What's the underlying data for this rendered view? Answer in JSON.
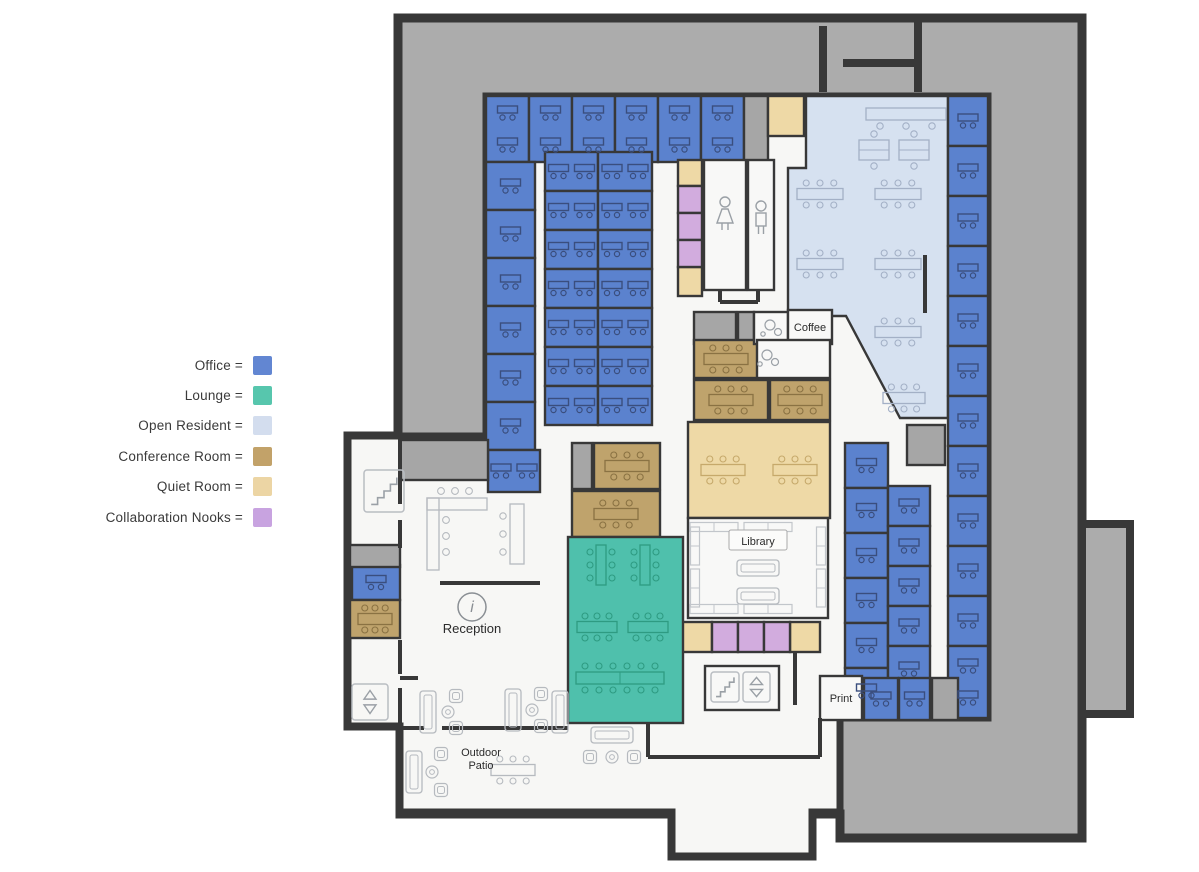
{
  "legend": {
    "items": [
      {
        "name": "office",
        "label": "Office =",
        "color": "#6286D2"
      },
      {
        "name": "lounge",
        "label": "Lounge =",
        "color": "#57C6AD"
      },
      {
        "name": "open-resident",
        "label": "Open Resident =",
        "color": "#D3DDEE"
      },
      {
        "name": "conference-room",
        "label": "Conference Room =",
        "color": "#C2A269"
      },
      {
        "name": "quiet-room",
        "label": "Quiet Room =",
        "color": "#ECD5A4"
      },
      {
        "name": "collaboration-nooks",
        "label": "Collaboration Nooks =",
        "color": "#C8A3E0"
      }
    ]
  },
  "plan": {
    "colors": {
      "wall": "#383838",
      "exterior": "#ACACAC",
      "floor": "#F7F7F5",
      "white": "#F8F8F7",
      "office": "#5B82CE",
      "lounge": "#4FC0AC",
      "open": "#D6E1F0",
      "conference": "#BFA36C",
      "quiet": "#EED9A6",
      "collab": "#D2ACDE",
      "grayroom": "#A6A6A6",
      "furn_office": "#3A4E7E",
      "furn_open": "#A3B0C6",
      "furn_conf": "#8A7243",
      "furn_quiet": "#C6A96B",
      "furn_lounge": "#2E9B82",
      "furn_neutral": "#B6BABF",
      "shelf": "#C2C6CB",
      "icon": "#9AA0A6",
      "iconbox": "#B9BDC2",
      "text": "#2B2B2B",
      "chip_border": "#AAAAAA"
    },
    "silhouette": "398,18 1082,18 1082,838 840,838 840,814 812,814 812,856 672,856 672,814 400,814 400,726 348,726 348,436 398,436",
    "bump": [
      1082,
      524,
      48,
      190
    ],
    "notch_walls": [
      [
        823,
        26,
        823,
        92
      ],
      [
        843,
        63,
        918,
        63
      ],
      [
        918,
        18,
        918,
        92
      ]
    ],
    "floor": "486,96 988,96 988,718 840,718 840,812 812,812 812,856 672,856 672,812 400,812 400,726 348,726 348,436 486,436",
    "open_area": {
      "points": "806,96 948,96 948,418 900,418 846,316 788,316 788,168 806,168"
    },
    "rooms": [
      {
        "t": "office",
        "x": 486,
        "y": 96,
        "w": 43,
        "h": 66
      },
      {
        "t": "office",
        "x": 529,
        "y": 96,
        "w": 43,
        "h": 66
      },
      {
        "t": "office",
        "x": 572,
        "y": 96,
        "w": 43,
        "h": 66
      },
      {
        "t": "office",
        "x": 615,
        "y": 96,
        "w": 43,
        "h": 66
      },
      {
        "t": "office",
        "x": 658,
        "y": 96,
        "w": 43,
        "h": 66
      },
      {
        "t": "office",
        "x": 701,
        "y": 96,
        "w": 43,
        "h": 66
      },
      {
        "t": "office",
        "x": 486,
        "y": 162,
        "w": 49,
        "h": 48
      },
      {
        "t": "office",
        "x": 486,
        "y": 210,
        "w": 49,
        "h": 48
      },
      {
        "t": "office",
        "x": 486,
        "y": 258,
        "w": 49,
        "h": 48
      },
      {
        "t": "office",
        "x": 486,
        "y": 306,
        "w": 49,
        "h": 48
      },
      {
        "t": "office",
        "x": 486,
        "y": 354,
        "w": 49,
        "h": 48
      },
      {
        "t": "office",
        "x": 486,
        "y": 402,
        "w": 49,
        "h": 48
      },
      {
        "t": "office",
        "x": 488,
        "y": 450,
        "w": 52,
        "h": 42
      },
      {
        "t": "office",
        "x": 545,
        "y": 152,
        "w": 53,
        "h": 39
      },
      {
        "t": "office",
        "x": 545,
        "y": 191,
        "w": 53,
        "h": 39
      },
      {
        "t": "office",
        "x": 545,
        "y": 230,
        "w": 53,
        "h": 39
      },
      {
        "t": "office",
        "x": 545,
        "y": 269,
        "w": 53,
        "h": 39
      },
      {
        "t": "office",
        "x": 545,
        "y": 308,
        "w": 53,
        "h": 39
      },
      {
        "t": "office",
        "x": 545,
        "y": 347,
        "w": 53,
        "h": 39
      },
      {
        "t": "office",
        "x": 545,
        "y": 386,
        "w": 53,
        "h": 39
      },
      {
        "t": "office",
        "x": 598,
        "y": 152,
        "w": 54,
        "h": 39
      },
      {
        "t": "office",
        "x": 598,
        "y": 191,
        "w": 54,
        "h": 39
      },
      {
        "t": "office",
        "x": 598,
        "y": 230,
        "w": 54,
        "h": 39
      },
      {
        "t": "office",
        "x": 598,
        "y": 269,
        "w": 54,
        "h": 39
      },
      {
        "t": "office",
        "x": 598,
        "y": 308,
        "w": 54,
        "h": 39
      },
      {
        "t": "office",
        "x": 598,
        "y": 347,
        "w": 54,
        "h": 39
      },
      {
        "t": "office",
        "x": 598,
        "y": 386,
        "w": 54,
        "h": 39
      },
      {
        "t": "office",
        "x": 948,
        "y": 96,
        "w": 40,
        "h": 50
      },
      {
        "t": "office",
        "x": 948,
        "y": 146,
        "w": 40,
        "h": 50
      },
      {
        "t": "office",
        "x": 948,
        "y": 196,
        "w": 40,
        "h": 50
      },
      {
        "t": "office",
        "x": 948,
        "y": 246,
        "w": 40,
        "h": 50
      },
      {
        "t": "office",
        "x": 948,
        "y": 296,
        "w": 40,
        "h": 50
      },
      {
        "t": "office",
        "x": 948,
        "y": 346,
        "w": 40,
        "h": 50
      },
      {
        "t": "office",
        "x": 948,
        "y": 396,
        "w": 40,
        "h": 50
      },
      {
        "t": "office",
        "x": 948,
        "y": 446,
        "w": 40,
        "h": 50
      },
      {
        "t": "office",
        "x": 948,
        "y": 496,
        "w": 40,
        "h": 50
      },
      {
        "t": "office",
        "x": 948,
        "y": 546,
        "w": 40,
        "h": 50
      },
      {
        "t": "office",
        "x": 948,
        "y": 596,
        "w": 40,
        "h": 50
      },
      {
        "t": "office",
        "x": 948,
        "y": 646,
        "w": 40,
        "h": 72
      },
      {
        "t": "office",
        "x": 845,
        "y": 443,
        "w": 43,
        "h": 45
      },
      {
        "t": "office",
        "x": 845,
        "y": 488,
        "w": 43,
        "h": 45
      },
      {
        "t": "office",
        "x": 845,
        "y": 533,
        "w": 43,
        "h": 45
      },
      {
        "t": "office",
        "x": 845,
        "y": 578,
        "w": 43,
        "h": 45
      },
      {
        "t": "office",
        "x": 845,
        "y": 623,
        "w": 43,
        "h": 45
      },
      {
        "t": "office",
        "x": 845,
        "y": 668,
        "w": 43,
        "h": 46
      },
      {
        "t": "office",
        "x": 888,
        "y": 486,
        "w": 42,
        "h": 40
      },
      {
        "t": "office",
        "x": 888,
        "y": 526,
        "w": 42,
        "h": 40
      },
      {
        "t": "office",
        "x": 888,
        "y": 566,
        "w": 42,
        "h": 40
      },
      {
        "t": "office",
        "x": 888,
        "y": 606,
        "w": 42,
        "h": 40
      },
      {
        "t": "office",
        "x": 888,
        "y": 646,
        "w": 42,
        "h": 46
      },
      {
        "t": "office",
        "x": 864,
        "y": 678,
        "w": 34,
        "h": 42
      },
      {
        "t": "office",
        "x": 899,
        "y": 678,
        "w": 31,
        "h": 42
      },
      {
        "t": "office",
        "x": 352,
        "y": 565,
        "w": 48,
        "h": 35
      },
      {
        "t": "grayroom",
        "x": 744,
        "y": 96,
        "w": 24,
        "h": 66
      },
      {
        "t": "grayroom",
        "x": 400,
        "y": 440,
        "w": 88,
        "h": 40
      },
      {
        "t": "grayroom",
        "x": 350,
        "y": 545,
        "w": 50,
        "h": 22
      },
      {
        "t": "grayroom",
        "x": 694,
        "y": 312,
        "w": 42,
        "h": 32
      },
      {
        "t": "grayroom",
        "x": 738,
        "y": 312,
        "w": 16,
        "h": 32
      },
      {
        "t": "grayroom",
        "x": 907,
        "y": 425,
        "w": 38,
        "h": 40
      },
      {
        "t": "grayroom",
        "x": 932,
        "y": 678,
        "w": 26,
        "h": 42
      },
      {
        "t": "grayroom",
        "x": 572,
        "y": 443,
        "w": 20,
        "h": 46
      },
      {
        "t": "conference",
        "x": 594,
        "y": 443,
        "w": 66,
        "h": 46
      },
      {
        "t": "conference",
        "x": 572,
        "y": 491,
        "w": 88,
        "h": 46
      },
      {
        "t": "conference",
        "x": 694,
        "y": 340,
        "w": 64,
        "h": 38
      },
      {
        "t": "conference",
        "x": 694,
        "y": 380,
        "w": 74,
        "h": 40
      },
      {
        "t": "conference",
        "x": 770,
        "y": 380,
        "w": 60,
        "h": 40
      },
      {
        "t": "conference",
        "x": 350,
        "y": 600,
        "w": 50,
        "h": 38
      },
      {
        "t": "quiet",
        "x": 688,
        "y": 422,
        "w": 142,
        "h": 96,
        "f": "2"
      },
      {
        "t": "quiet",
        "x": 768,
        "y": 96,
        "w": 36,
        "h": 40
      },
      {
        "t": "quiet",
        "x": 678,
        "y": 160,
        "w": 24,
        "h": 26
      },
      {
        "t": "quiet",
        "x": 678,
        "y": 267,
        "w": 24,
        "h": 29
      },
      {
        "t": "quiet",
        "x": 682,
        "y": 622,
        "w": 30,
        "h": 30
      },
      {
        "t": "quiet",
        "x": 790,
        "y": 622,
        "w": 30,
        "h": 30
      },
      {
        "t": "collab",
        "x": 678,
        "y": 186,
        "w": 24,
        "h": 27
      },
      {
        "t": "collab",
        "x": 678,
        "y": 213,
        "w": 24,
        "h": 27
      },
      {
        "t": "collab",
        "x": 678,
        "y": 240,
        "w": 24,
        "h": 27
      },
      {
        "t": "collab",
        "x": 712,
        "y": 622,
        "w": 26,
        "h": 30
      },
      {
        "t": "collab",
        "x": 738,
        "y": 622,
        "w": 26,
        "h": 30
      },
      {
        "t": "collab",
        "x": 764,
        "y": 622,
        "w": 26,
        "h": 30
      },
      {
        "t": "lounge",
        "x": 568,
        "y": 537,
        "w": 115,
        "h": 186
      },
      {
        "t": "white",
        "x": 704,
        "y": 160,
        "w": 42,
        "h": 130
      },
      {
        "t": "white",
        "x": 748,
        "y": 160,
        "w": 26,
        "h": 130
      },
      {
        "t": "white",
        "x": 754,
        "y": 312,
        "w": 34,
        "h": 32
      },
      {
        "t": "white",
        "x": 788,
        "y": 310,
        "w": 44,
        "h": 34
      },
      {
        "t": "white",
        "x": 757,
        "y": 340,
        "w": 73,
        "h": 38
      },
      {
        "t": "white",
        "x": 820,
        "y": 676,
        "w": 42,
        "h": 44
      },
      {
        "t": "white",
        "x": 688,
        "y": 518,
        "w": 140,
        "h": 100
      },
      {
        "t": "white",
        "x": 705,
        "y": 666,
        "w": 74,
        "h": 44
      }
    ],
    "walls": [
      [
        400,
        436,
        400,
        504
      ],
      [
        400,
        520,
        400,
        548
      ],
      [
        440,
        583,
        540,
        583
      ],
      [
        925,
        255,
        925,
        313
      ],
      [
        400,
        640,
        400,
        674
      ],
      [
        400,
        688,
        400,
        726
      ],
      [
        400,
        678,
        418,
        678
      ],
      [
        648,
        723,
        648,
        757
      ],
      [
        648,
        757,
        820,
        757
      ],
      [
        820,
        718,
        820,
        757
      ],
      [
        400,
        728,
        424,
        728
      ],
      [
        442,
        728,
        568,
        728
      ],
      [
        795,
        652,
        795,
        705
      ],
      [
        720,
        290,
        720,
        302
      ],
      [
        720,
        302,
        758,
        302
      ],
      [
        758,
        302,
        758,
        290
      ]
    ],
    "furniture": [
      {
        "k": "counter3",
        "x": 906,
        "y": 114,
        "p": "open"
      },
      {
        "k": "deskpair",
        "x": 874,
        "y": 150,
        "p": "open"
      },
      {
        "k": "deskpair",
        "x": 914,
        "y": 150,
        "p": "open"
      },
      {
        "k": "table6",
        "x": 820,
        "y": 194,
        "w": 46,
        "p": "open"
      },
      {
        "k": "table6",
        "x": 898,
        "y": 194,
        "w": 46,
        "p": "open"
      },
      {
        "k": "table6",
        "x": 820,
        "y": 264,
        "w": 46,
        "p": "open"
      },
      {
        "k": "table6",
        "x": 898,
        "y": 264,
        "w": 46,
        "p": "open"
      },
      {
        "k": "table6",
        "x": 898,
        "y": 332,
        "w": 46,
        "p": "open"
      },
      {
        "k": "table6",
        "x": 904,
        "y": 398,
        "w": 42,
        "p": "open"
      },
      {
        "k": "table2v",
        "x": 601,
        "y": 565,
        "p": "lounge"
      },
      {
        "k": "table2v",
        "x": 645,
        "y": 565,
        "p": "lounge"
      },
      {
        "k": "table6",
        "x": 597,
        "y": 627,
        "w": 40,
        "p": "lounge"
      },
      {
        "k": "table6",
        "x": 648,
        "y": 627,
        "w": 40,
        "p": "lounge"
      },
      {
        "k": "longtable",
        "x": 620,
        "y": 678,
        "p": "lounge"
      },
      {
        "k": "shelfH",
        "x": 714,
        "y": 527,
        "p": "shelf"
      },
      {
        "k": "shelfH",
        "x": 768,
        "y": 527,
        "p": "shelf"
      },
      {
        "k": "shelfH",
        "x": 714,
        "y": 609,
        "p": "shelf"
      },
      {
        "k": "shelfH",
        "x": 768,
        "y": 609,
        "p": "shelf"
      },
      {
        "k": "shelfV",
        "x": 695,
        "y": 546,
        "p": "shelf"
      },
      {
        "k": "shelfV",
        "x": 695,
        "y": 588,
        "p": "shelf"
      },
      {
        "k": "shelfV",
        "x": 821,
        "y": 546,
        "p": "shelf"
      },
      {
        "k": "shelfV",
        "x": 821,
        "y": 588,
        "p": "shelf"
      },
      {
        "k": "couchH",
        "x": 758,
        "y": 568,
        "p": "neutral"
      },
      {
        "k": "couchH",
        "x": 758,
        "y": 596,
        "p": "neutral"
      },
      {
        "k": "ldesk",
        "x": 457,
        "y": 532,
        "p": "neutral"
      },
      {
        "k": "deskV3",
        "x": 517,
        "y": 534,
        "p": "neutral"
      },
      {
        "k": "couchV",
        "x": 428,
        "y": 712,
        "p": "neutral"
      },
      {
        "k": "chair",
        "x": 456,
        "y": 696,
        "p": "neutral"
      },
      {
        "k": "chair",
        "x": 456,
        "y": 728,
        "p": "neutral"
      },
      {
        "k": "rtable",
        "x": 448,
        "y": 712,
        "p": "neutral"
      },
      {
        "k": "couchV",
        "x": 513,
        "y": 710,
        "p": "neutral"
      },
      {
        "k": "chair",
        "x": 541,
        "y": 694,
        "p": "neutral"
      },
      {
        "k": "chair",
        "x": 541,
        "y": 726,
        "p": "neutral"
      },
      {
        "k": "rtable",
        "x": 532,
        "y": 710,
        "p": "neutral"
      },
      {
        "k": "couchV",
        "x": 560,
        "y": 712,
        "p": "neutral"
      },
      {
        "k": "couchV",
        "x": 414,
        "y": 772,
        "p": "neutral"
      },
      {
        "k": "chair",
        "x": 441,
        "y": 754,
        "p": "neutral"
      },
      {
        "k": "chair",
        "x": 441,
        "y": 790,
        "p": "neutral"
      },
      {
        "k": "rtable",
        "x": 432,
        "y": 772,
        "p": "neutral"
      },
      {
        "k": "couchH",
        "x": 612,
        "y": 735,
        "p": "neutral"
      },
      {
        "k": "chair",
        "x": 590,
        "y": 757,
        "p": "neutral"
      },
      {
        "k": "chair",
        "x": 634,
        "y": 757,
        "p": "neutral"
      },
      {
        "k": "rtable",
        "x": 612,
        "y": 757,
        "p": "neutral"
      },
      {
        "k": "table6",
        "x": 513,
        "y": 770,
        "w": 44,
        "p": "neutral"
      }
    ],
    "icons": [
      {
        "kind": "stairs",
        "x": 364,
        "y": 470,
        "w": 40,
        "h": 42,
        "box": true
      },
      {
        "kind": "stairs",
        "x": 711,
        "y": 672,
        "w": 28,
        "h": 30,
        "box": true
      },
      {
        "kind": "elevator",
        "x": 352,
        "y": 684,
        "w": 36,
        "h": 36
      },
      {
        "kind": "elevator",
        "x": 743,
        "y": 672,
        "w": 27,
        "h": 30
      },
      {
        "kind": "info",
        "x": 472,
        "y": 607
      },
      {
        "kind": "woman",
        "x": 725,
        "y": 202
      },
      {
        "kind": "man",
        "x": 761,
        "y": 206
      },
      {
        "kind": "cups",
        "x": 770,
        "y": 325
      },
      {
        "kind": "cups",
        "x": 767,
        "y": 355
      }
    ],
    "labels": [
      {
        "text": "Reception",
        "x": 472,
        "y": 633,
        "size": 13
      },
      {
        "text": "Coffee",
        "x": 810,
        "y": 331,
        "size": 11
      },
      {
        "text": "Library",
        "x": 758,
        "y": 545,
        "size": 11,
        "chip": [
          729,
          530,
          58,
          20
        ]
      },
      {
        "text": "Print",
        "x": 841,
        "y": 702,
        "size": 11
      },
      {
        "text": "Outdoor",
        "x": 481,
        "y": 756,
        "size": 11
      },
      {
        "text": "Patio",
        "x": 481,
        "y": 769,
        "size": 11
      }
    ]
  }
}
